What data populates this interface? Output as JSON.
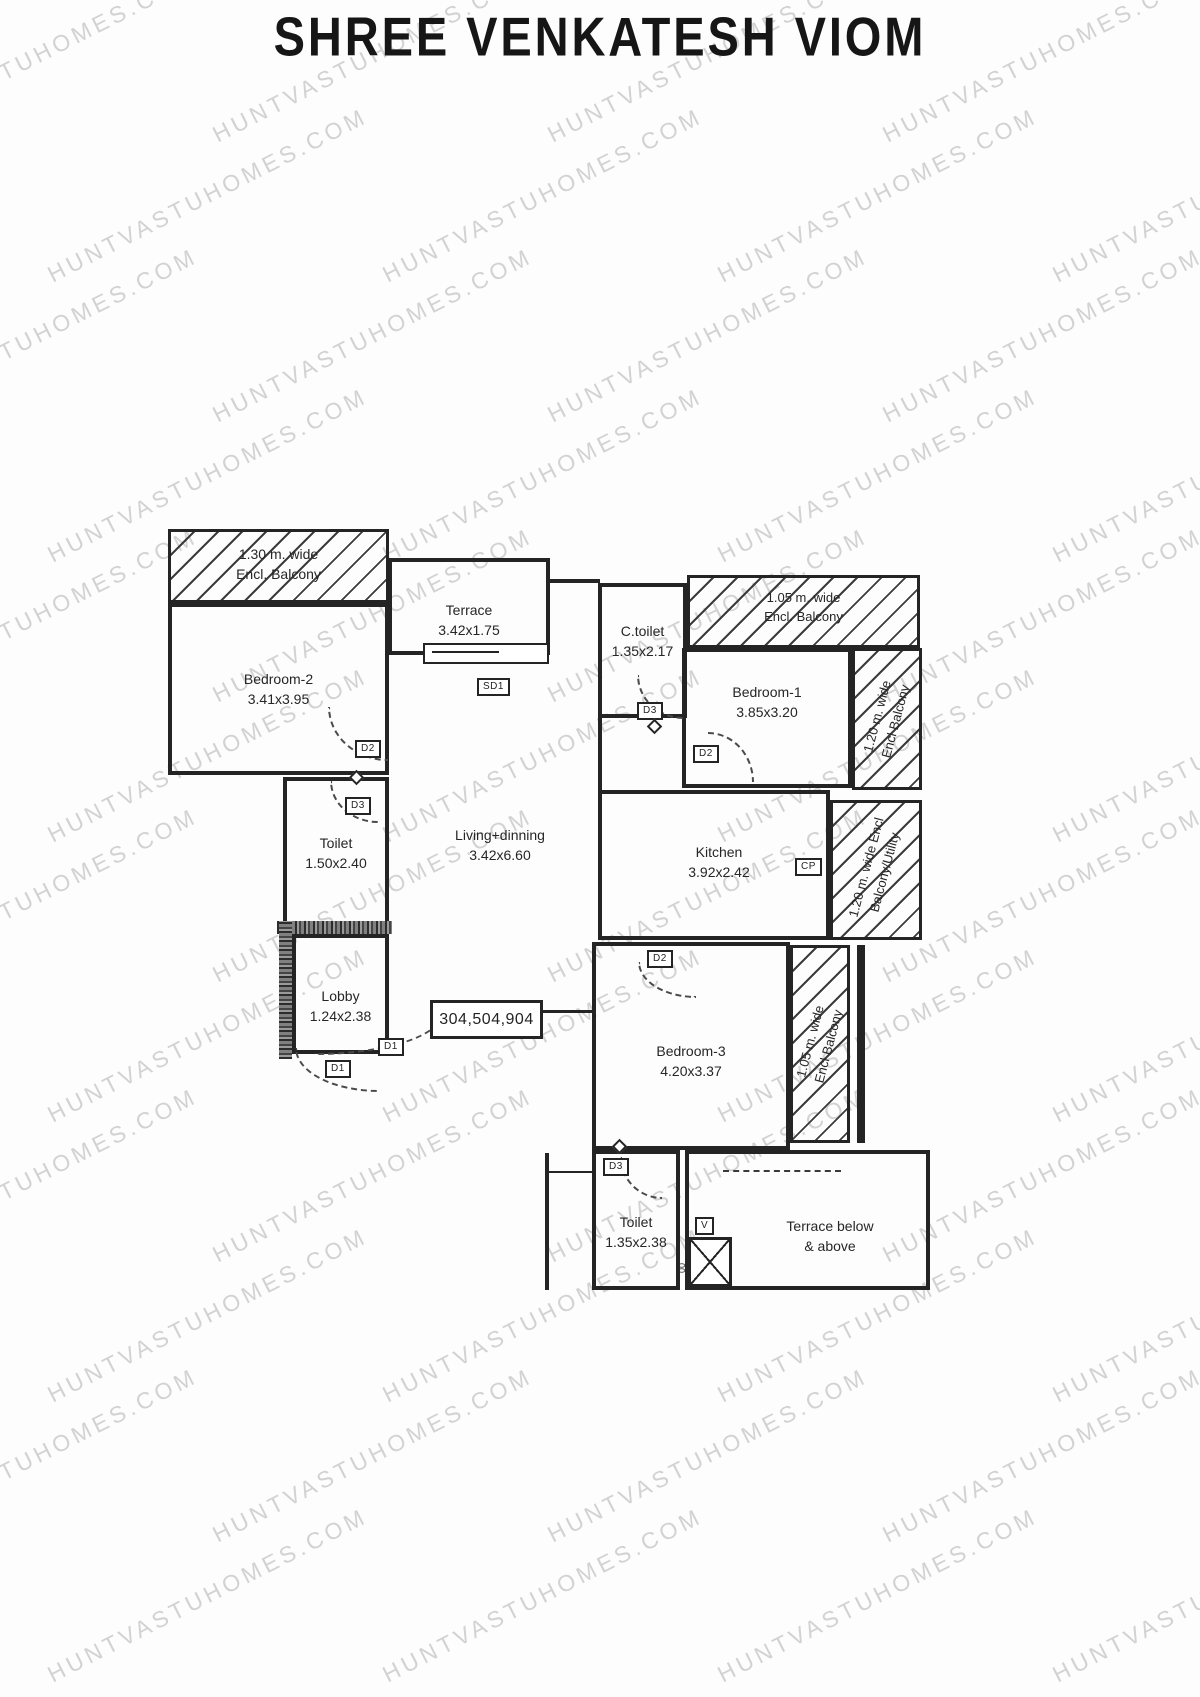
{
  "title": "SHREE VENKATESH VIOM",
  "watermark": "HUNTVASTUHOMES.COM",
  "unit_numbers": "304,504,904",
  "doors": {
    "d1": "D1",
    "d2": "D2",
    "d3": "D3",
    "sd1": "SD1",
    "cp": "CP",
    "v": "V",
    "duct": "00"
  },
  "rooms": {
    "balcony_top_left": {
      "line1": "1.30 m. wide",
      "line2": "Encl. Balcony"
    },
    "bedroom2": {
      "name": "Bedroom-2",
      "dim": "3.41x3.95"
    },
    "terrace": {
      "name": "Terrace",
      "dim": "3.42x1.75"
    },
    "c_toilet": {
      "name": "C.toilet",
      "dim": "1.35x2.17"
    },
    "balcony_top_right": {
      "line1": "1.05 m. wide",
      "line2": "Encl. Balcony"
    },
    "bedroom1": {
      "name": "Bedroom-1",
      "dim": "3.85x3.20"
    },
    "balcony_right": {
      "line1": "1.20 m. wide",
      "line2": "Encl Balcony"
    },
    "toilet": {
      "name": "Toilet",
      "dim": "1.50x2.40"
    },
    "living": {
      "name": "Living+dinning",
      "dim": "3.42x6.60"
    },
    "kitchen": {
      "name": "Kitchen",
      "dim": "3.92x2.42"
    },
    "balcony_utility": {
      "line1": "1.20 m. wide Encl",
      "line2": "Balcony/Utility"
    },
    "lobby": {
      "name": "Lobby",
      "dim": "1.24x2.38"
    },
    "bedroom3": {
      "name": "Bedroom-3",
      "dim": "4.20x3.37"
    },
    "balcony_bedroom3": {
      "line1": "1.05 m. wide",
      "line2": "Encl Balcony"
    },
    "toilet_bottom": {
      "name": "Toilet",
      "dim": "1.35x2.38"
    },
    "terrace_below": {
      "line1": "Terrace below",
      "line2": "& above"
    }
  }
}
